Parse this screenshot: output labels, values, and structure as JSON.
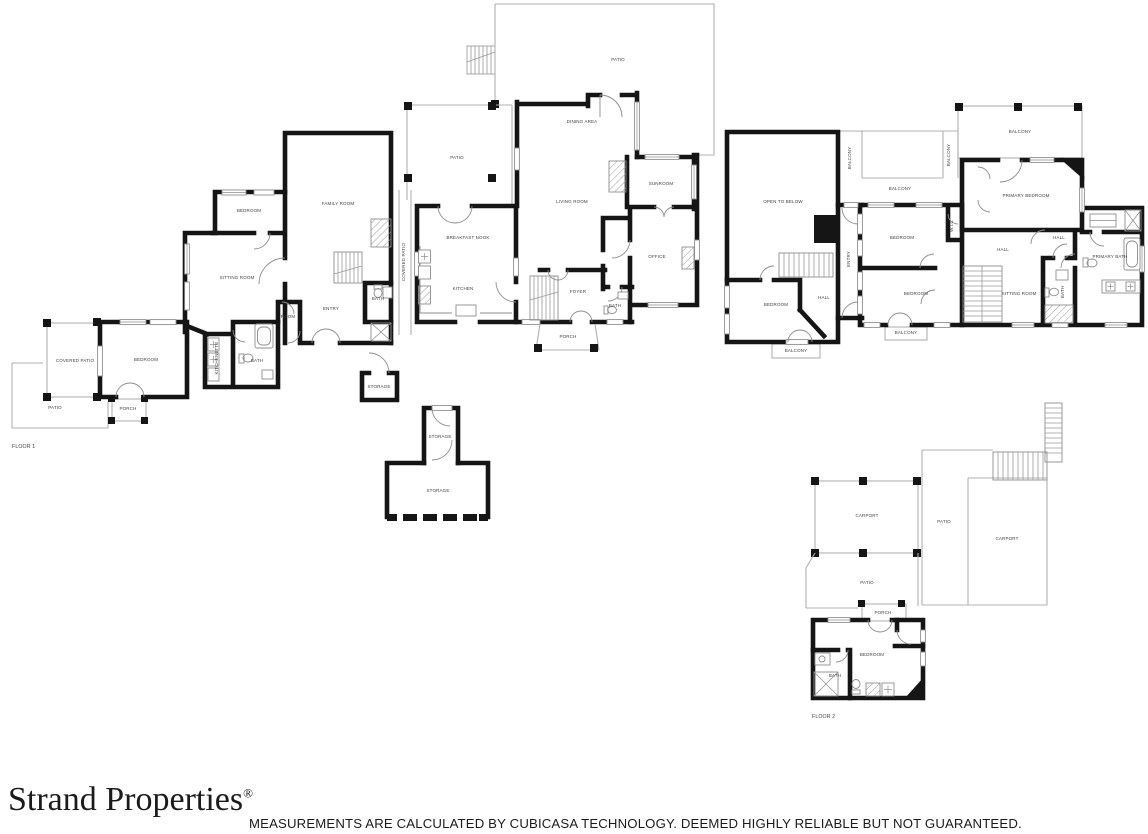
{
  "page": {
    "background": "#ffffff"
  },
  "colors": {
    "wall": "#151515",
    "thin_line": "#b0b0b0",
    "fixture_line": "#8d8d8d",
    "label_text": "#3f3f3f",
    "footer_text": "#1b1b1b"
  },
  "branding": {
    "logo_text": "Strand Properties",
    "registered_mark": "®"
  },
  "disclaimer": {
    "text": "MEASUREMENTS ARE CALCULATED BY CUBICASA TECHNOLOGY. DEEMED HIGHLY RELIABLE BUT NOT GUARANTEED."
  },
  "floor_plan": {
    "floor_1": {
      "title": "FLOOR 1",
      "labels": [
        {
          "text": "PATIO",
          "x": 618,
          "y": 61
        },
        {
          "text": "DINING AREA",
          "x": 582,
          "y": 123
        },
        {
          "text": "PATIO",
          "x": 457,
          "y": 159
        },
        {
          "text": "LIVING ROOM",
          "x": 572,
          "y": 203
        },
        {
          "text": "SUNROOM",
          "x": 661,
          "y": 185
        },
        {
          "text": "OFFICE",
          "x": 657,
          "y": 258
        },
        {
          "text": "FOYER",
          "x": 578,
          "y": 293
        },
        {
          "text": "BATH",
          "x": 615,
          "y": 307
        },
        {
          "text": "PORCH",
          "x": 568,
          "y": 338
        },
        {
          "text": "BREAKFAST NOOK",
          "x": 468,
          "y": 239
        },
        {
          "text": "KITCHEN",
          "x": 463,
          "y": 290
        },
        {
          "text": "COVERED PATIO",
          "x": 405,
          "y": 262,
          "rot": -90
        },
        {
          "text": "FAMILY ROOM",
          "x": 338,
          "y": 205
        },
        {
          "text": "BEDROOM",
          "x": 249,
          "y": 212
        },
        {
          "text": "SITTING ROOM",
          "x": 237,
          "y": 279
        },
        {
          "text": "ENTRY",
          "x": 331,
          "y": 310
        },
        {
          "text": "BATH",
          "x": 378,
          "y": 300
        },
        {
          "text": "ROOM",
          "x": 288,
          "y": 318
        },
        {
          "text": "KITCHENETTE",
          "x": 218,
          "y": 358,
          "rot": -90
        },
        {
          "text": "BATH",
          "x": 257,
          "y": 362
        },
        {
          "text": "BEDROOM",
          "x": 146,
          "y": 361
        },
        {
          "text": "COVERED PATIO",
          "x": 75,
          "y": 362
        },
        {
          "text": "PATIO",
          "x": 55,
          "y": 409
        },
        {
          "text": "PORCH",
          "x": 128,
          "y": 410
        },
        {
          "text": "STORAGE",
          "x": 379,
          "y": 388
        },
        {
          "text": "STORAGE",
          "x": 440,
          "y": 438
        },
        {
          "text": "STORAGE",
          "x": 438,
          "y": 492
        }
      ]
    },
    "floor_2": {
      "title": "FLOOR 2",
      "labels": [
        {
          "text": "OPEN TO BELOW",
          "x": 783,
          "y": 203
        },
        {
          "text": "BEDROOM",
          "x": 776,
          "y": 306
        },
        {
          "text": "HALL",
          "x": 824,
          "y": 299
        },
        {
          "text": "BALCONY",
          "x": 796,
          "y": 352
        },
        {
          "text": "ENTRY",
          "x": 850,
          "y": 259,
          "rot": -90
        },
        {
          "text": "BALCONY",
          "x": 851,
          "y": 158,
          "rot": -90
        },
        {
          "text": "BALCONY",
          "x": 900,
          "y": 190
        },
        {
          "text": "BALCONY",
          "x": 950,
          "y": 155,
          "rot": -90
        },
        {
          "text": "BEDROOM",
          "x": 902,
          "y": 239
        },
        {
          "text": "BEDROOM",
          "x": 916,
          "y": 295
        },
        {
          "text": "W.I.C",
          "x": 953,
          "y": 226,
          "rot": -90
        },
        {
          "text": "BALCONY",
          "x": 906,
          "y": 334
        },
        {
          "text": "HALL",
          "x": 1003,
          "y": 251
        },
        {
          "text": "SITTING ROOM",
          "x": 1019,
          "y": 295
        },
        {
          "text": "PRIMARY BEDROOM",
          "x": 1026,
          "y": 197
        },
        {
          "text": "BALCONY",
          "x": 1020,
          "y": 133
        },
        {
          "text": "HALL",
          "x": 1059,
          "y": 239
        },
        {
          "text": "PRIMARY BATH",
          "x": 1110,
          "y": 258
        },
        {
          "text": "BATH",
          "x": 1064,
          "y": 292,
          "rot": -90
        },
        {
          "text": "CARPORT",
          "x": 867,
          "y": 517
        },
        {
          "text": "PATIO",
          "x": 944,
          "y": 523
        },
        {
          "text": "CARPORT",
          "x": 1007,
          "y": 540
        },
        {
          "text": "PATIO",
          "x": 867,
          "y": 584
        },
        {
          "text": "PORCH",
          "x": 883,
          "y": 614
        },
        {
          "text": "BEDROOM",
          "x": 872,
          "y": 656
        },
        {
          "text": "BATH",
          "x": 835,
          "y": 677
        }
      ]
    }
  }
}
